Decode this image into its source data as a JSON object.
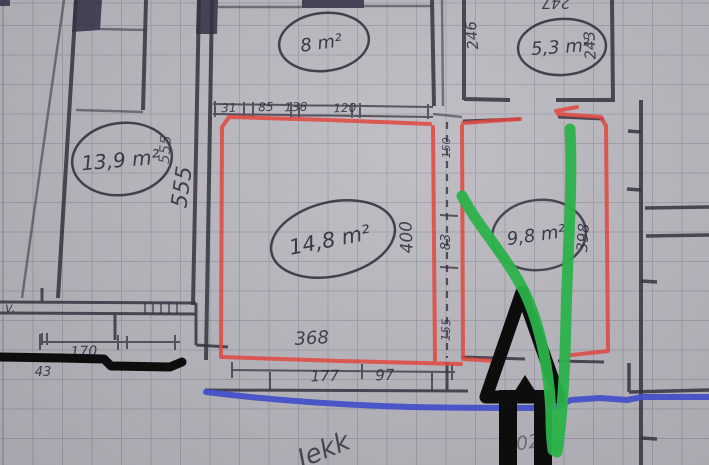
{
  "colors": {
    "paper": "#bab8bf",
    "grid": "#9e9ca7",
    "pencil": "#35323f",
    "red_marker": "#e0463f",
    "green_marker": "#2bb24a",
    "blue_marker": "#4450c8",
    "black_marker": "#0d0d0d"
  },
  "rooms": {
    "left": "13,9 m²",
    "top_middle": "8 m²",
    "top_right": "5,3 m²",
    "center": "14,8 m²",
    "right": "9,8 m²"
  },
  "dims": {
    "wall_555_thin": "555",
    "wall_555_bold": "555",
    "d246": "246",
    "d243": "243",
    "d247": "247",
    "top_row": [
      "31",
      "85",
      "138",
      "120"
    ],
    "d400": "400",
    "d150": "150",
    "d83": "83",
    "d155": "155",
    "d398": "398",
    "d368": "368",
    "d177": "177",
    "d97": "97",
    "d170": "170",
    "d43": "43"
  },
  "notes": {
    "margin_v": "v.",
    "scribble_center": "Jekk",
    "scribble_right": "902"
  }
}
